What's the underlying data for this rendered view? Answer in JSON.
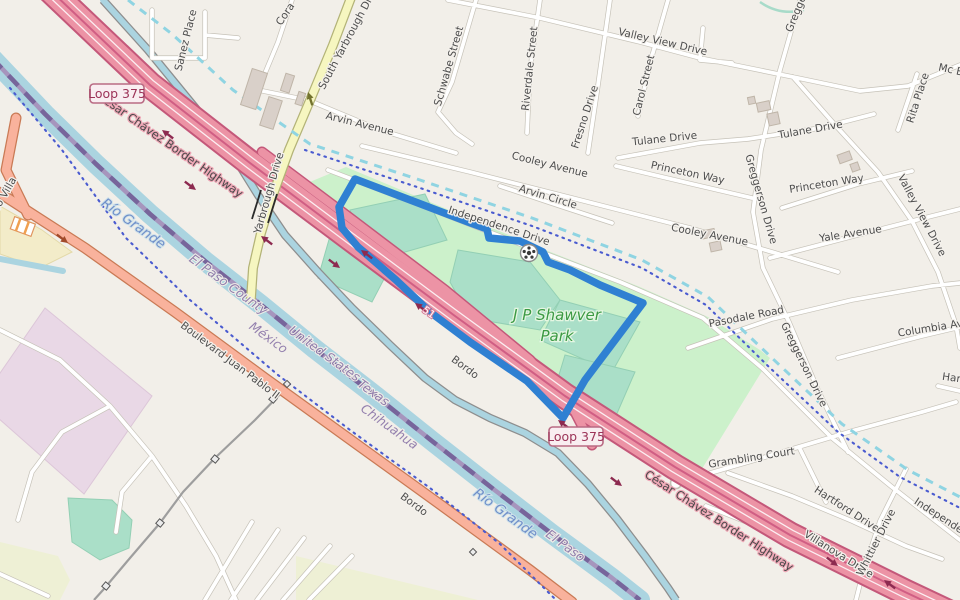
{
  "map_type": "openstreetmap-style slippy map with selected park outlined in blue",
  "selection": {
    "feature": "J P Shawver Park",
    "outline_color": "#2f80d2"
  },
  "park": {
    "name_line1": "J P Shawver",
    "name_line2": "Park"
  },
  "badges": [
    {
      "text": "Loop 375"
    },
    {
      "text": "Loop 375"
    }
  ],
  "highway_labels": [
    {
      "text": "César Chávez Border Highway"
    },
    {
      "text": "César Chávez Border Highway"
    }
  ],
  "highway_ref_small": {
    "text": "51"
  },
  "street_labels": [
    {
      "text": "Sanez Place"
    },
    {
      "text": "Cora"
    },
    {
      "text": "South Yarbrough Drive"
    },
    {
      "text": "Yarbrough Drive"
    },
    {
      "text": "Valley View Drive"
    },
    {
      "text": "Mc E"
    },
    {
      "text": "Rita Place"
    },
    {
      "text": "Carol Street"
    },
    {
      "text": "Schwabe Street"
    },
    {
      "text": "Riverdale Street"
    },
    {
      "text": "Fresno Drive"
    },
    {
      "text": "Arvin Avenue"
    },
    {
      "text": "Cooley Avenue"
    },
    {
      "text": "Arvin Circle"
    },
    {
      "text": "Independence Drive"
    },
    {
      "text": "Cooley Avenue"
    },
    {
      "text": "Tulane Drive"
    },
    {
      "text": "Tulane Drive"
    },
    {
      "text": "Princeton Way"
    },
    {
      "text": "Princeton Way"
    },
    {
      "text": "Gregge"
    },
    {
      "text": "Greggerson Drive"
    },
    {
      "text": "Greggerson Drive"
    },
    {
      "text": "Yale Avenue"
    },
    {
      "text": "Valley View Drive"
    },
    {
      "text": "Pasodale Road"
    },
    {
      "text": "Columbia Ave"
    },
    {
      "text": "Har"
    },
    {
      "text": "Grambling Court"
    },
    {
      "text": "Hartford Drive"
    },
    {
      "text": "Villanova Drive"
    },
    {
      "text": "Whittier Drive"
    },
    {
      "text": "Independence Drive"
    },
    {
      "text": "Bordo"
    },
    {
      "text": "Bordo"
    },
    {
      "text": "Boulevard Juan Pablo II"
    },
    {
      "text": "Francisco Villa"
    }
  ],
  "boundary_labels": [
    {
      "text": "El Paso County"
    },
    {
      "text": "México"
    },
    {
      "text": "United States"
    },
    {
      "text": "Texas"
    },
    {
      "text": "Chihuahua"
    },
    {
      "text": "El Paso"
    }
  ],
  "water_labels": [
    {
      "text": "Río Grande"
    },
    {
      "text": "Río Grande"
    }
  ],
  "colors": {
    "background": "#f2efe9",
    "motorway_fill": "#ec93a5",
    "motorway_casing": "#c4587a",
    "trunk_fill": "#f9b29c",
    "secondary_fill": "#f6f6c0",
    "water": "#abd4e0",
    "park_green": "#ccf1cb",
    "pitch_teal": "#aadfc8",
    "industrial": "#e9d8e6",
    "farmland": "#eef0d5",
    "selection_blue": "#2f80d2",
    "boundary_dots": "#4a5bd0",
    "intermittent_stream": "#8fd4e2",
    "building": "#d9d0c9",
    "badge_text": "#9c3358"
  }
}
